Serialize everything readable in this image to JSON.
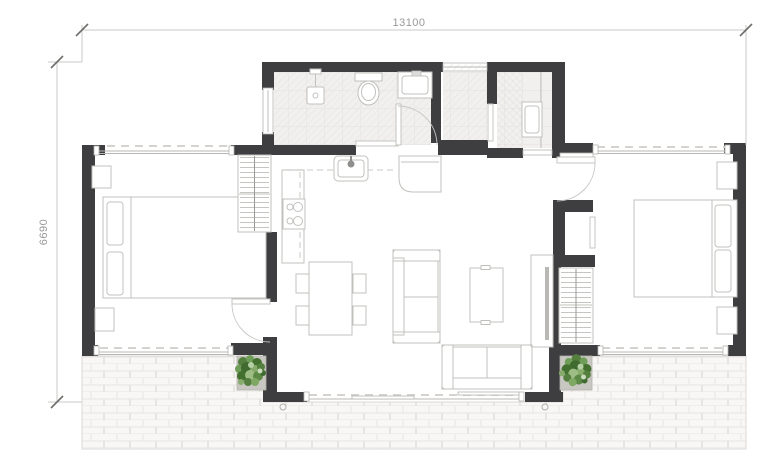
{
  "dimensions": {
    "width_label": "13100",
    "height_label": "6690"
  },
  "colors": {
    "wall": "#3e3e40",
    "dim_line": "#c9c8c5",
    "dim_text": "#9a9998",
    "furniture_line": "#c1c0bd",
    "door_line": "#c5c4c1",
    "glazing": "#b8b7b4",
    "dash": "#d4d3d0",
    "tile_floor": "#f1f0ee",
    "tile_grid": "#e3e2e0",
    "terrace_fill": "#f8f7f5",
    "terrace_line": "#e7e5e1",
    "planter": "#c9c7c2",
    "plant_dark": "#3f6b31",
    "plant_mid": "#5c8a46",
    "plant_light": "#9dbd85",
    "tv": "#b9b8b5"
  },
  "icons": [
    "double-bed-icon",
    "pillow-icon",
    "nightstand-icon",
    "wardrobe-icon",
    "sofa-icon",
    "coffee-table-icon",
    "tv-console-icon",
    "dining-table-icon",
    "chair-icon",
    "kitchen-sink-icon",
    "cooktop-icon",
    "fridge-icon",
    "counter-icon",
    "toilet-icon",
    "washbasin-icon",
    "shower-icon",
    "washing-machine-icon",
    "door-swing-icon",
    "window-icon",
    "sliding-door-icon",
    "plant-icon",
    "planter-icon",
    "downspout-icon"
  ]
}
